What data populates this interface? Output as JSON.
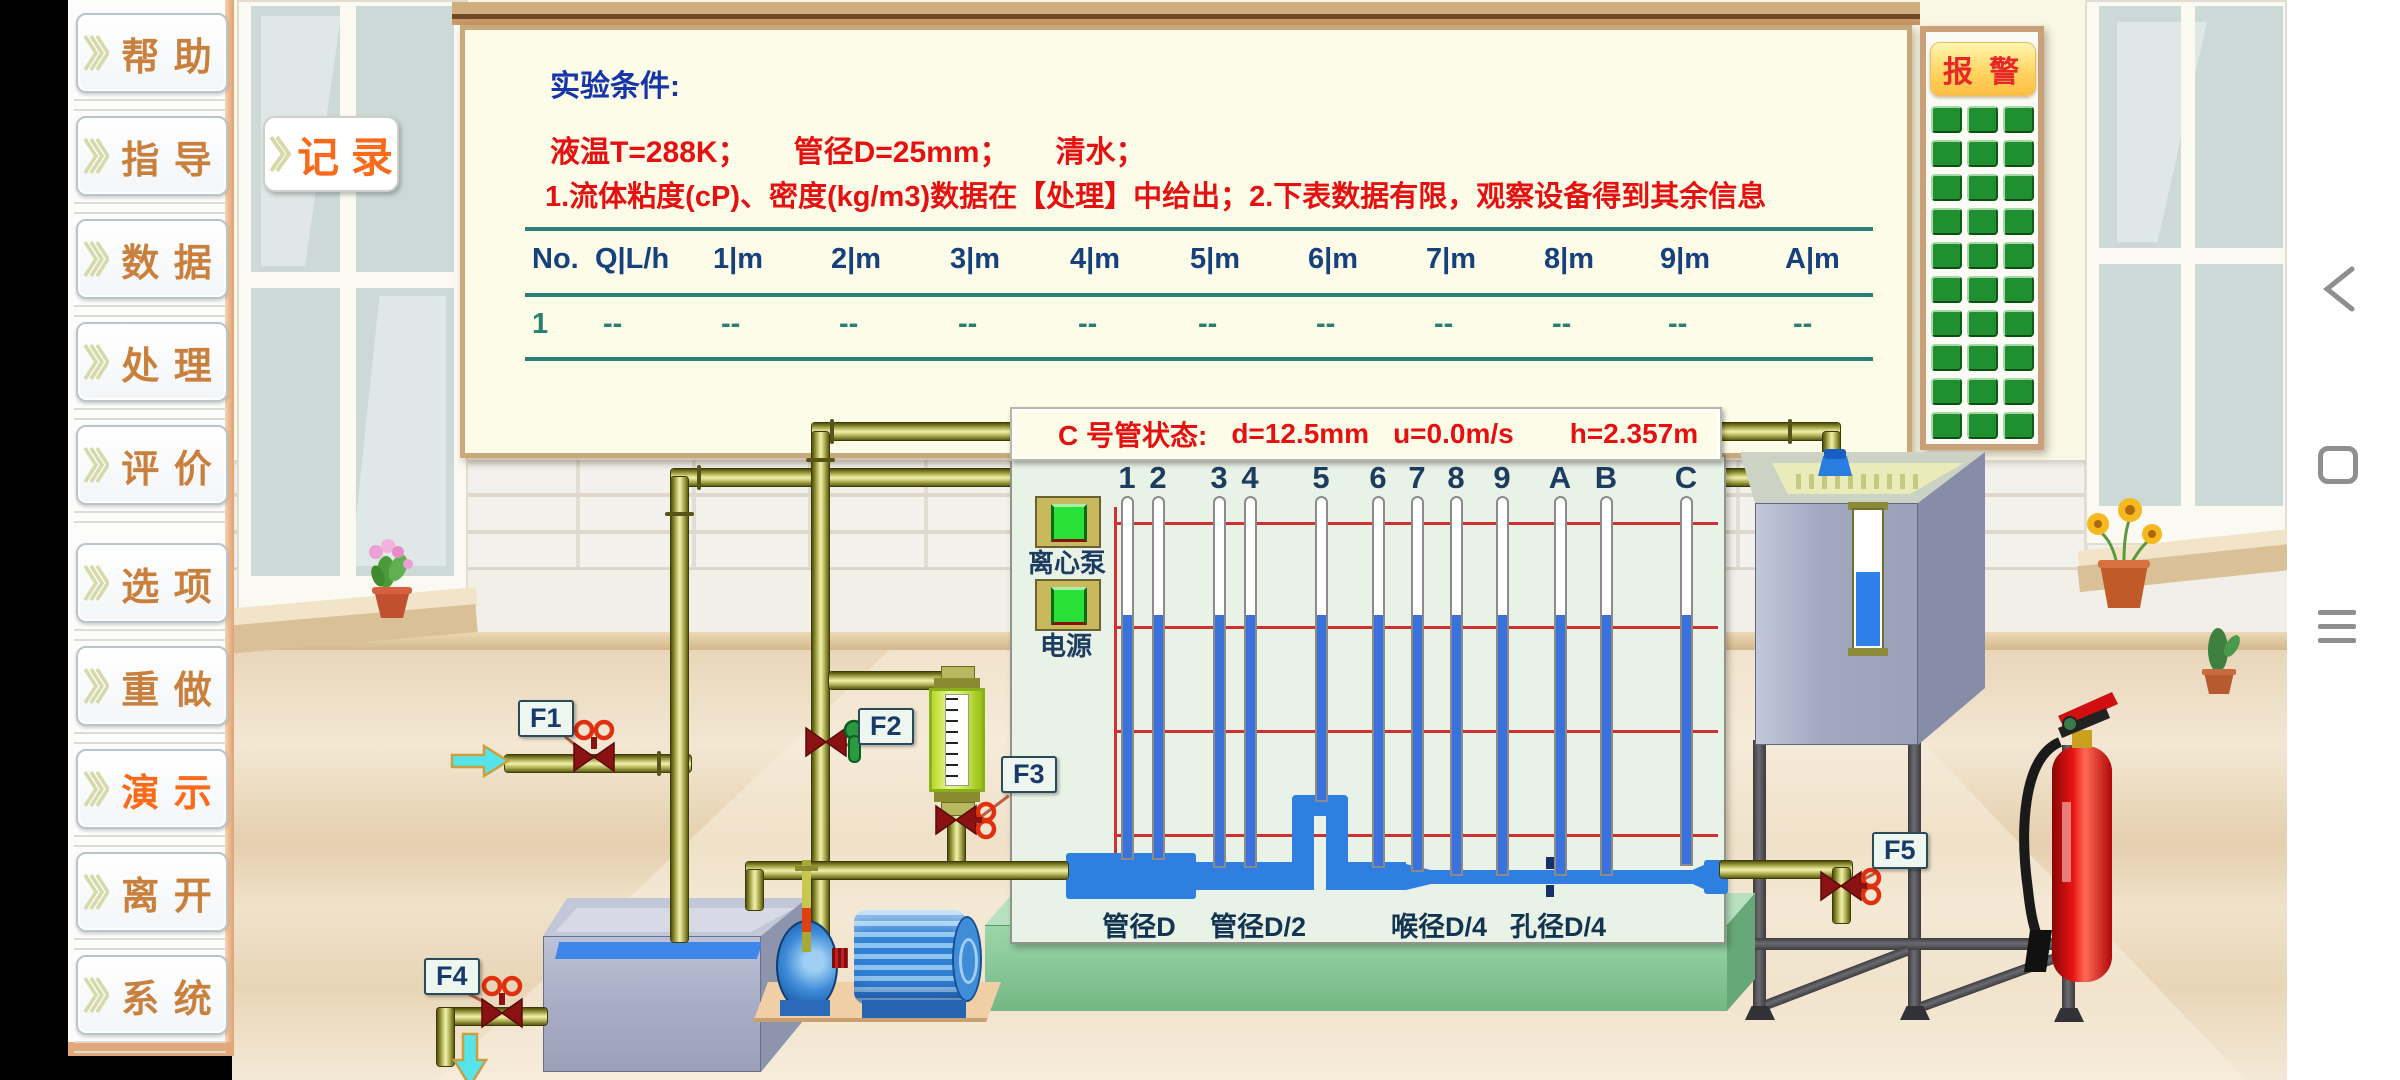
{
  "sidebar": {
    "items": [
      {
        "id": "help",
        "label": "帮 助"
      },
      {
        "id": "guide",
        "label": "指 导"
      },
      {
        "id": "data",
        "label": "数 据"
      },
      {
        "id": "process",
        "label": "处 理"
      },
      {
        "id": "evaluate",
        "label": "评 价"
      },
      {
        "id": "options",
        "label": "选 项"
      },
      {
        "id": "redo",
        "label": "重 做"
      },
      {
        "id": "demo",
        "label": "演 示",
        "highlight": true
      },
      {
        "id": "leave",
        "label": "离 开"
      },
      {
        "id": "system",
        "label": "系 统"
      }
    ]
  },
  "record_button": {
    "label": "记 录"
  },
  "whiteboard": {
    "title": "实验条件:",
    "conditions": [
      "液温T=288K；",
      "管径D=25mm；",
      "清水；"
    ],
    "note": "1.流体粘度(cP)、密度(kg/m3)数据在【处理】中给出；2.下表数据有限，观察设备得到其余信息",
    "table": {
      "headers": [
        "No.",
        "Q|L/h",
        "1|m",
        "2|m",
        "3|m",
        "4|m",
        "5|m",
        "6|m",
        "7|m",
        "8|m",
        "9|m",
        "A|m"
      ],
      "row": [
        "1",
        "--",
        "--",
        "--",
        "--",
        "--",
        "--",
        "--",
        "--",
        "--",
        "--",
        "--"
      ]
    }
  },
  "status_bar": {
    "title": "C 号管状态:",
    "items": [
      "d=12.5mm",
      "u=0.0m/s",
      "h=2.357m"
    ]
  },
  "panel": {
    "pump_button": "离心泵",
    "power_button": "电源",
    "tube_labels": [
      "1",
      "2",
      "3",
      "4",
      "5",
      "6",
      "7",
      "8",
      "9",
      "A",
      "B",
      "C"
    ],
    "section_labels": [
      "管径D",
      "管径D/2",
      "喉径D/4",
      "孔径D/4"
    ]
  },
  "alarm": {
    "title": "报 警",
    "grid": {
      "rows": 10,
      "cols": 3
    }
  },
  "valve_labels": [
    "F1",
    "F2",
    "F3",
    "F4",
    "F5"
  ],
  "colors": {
    "menu_text": "#c8803c",
    "menu_highlight": "#fb6a18",
    "record_text": "#f96a1b",
    "red_text": "#e51010",
    "blue_heading": "#1535a8",
    "table_header": "#16417c",
    "table_row": "#2a8070",
    "divider_teal": "#2a8077",
    "tube_water": "#3a72dd",
    "grid_red": "#d03030",
    "alarm_green": "#1f8f2f",
    "alarm_title": "#e82828",
    "label_navy": "#173a6a"
  }
}
